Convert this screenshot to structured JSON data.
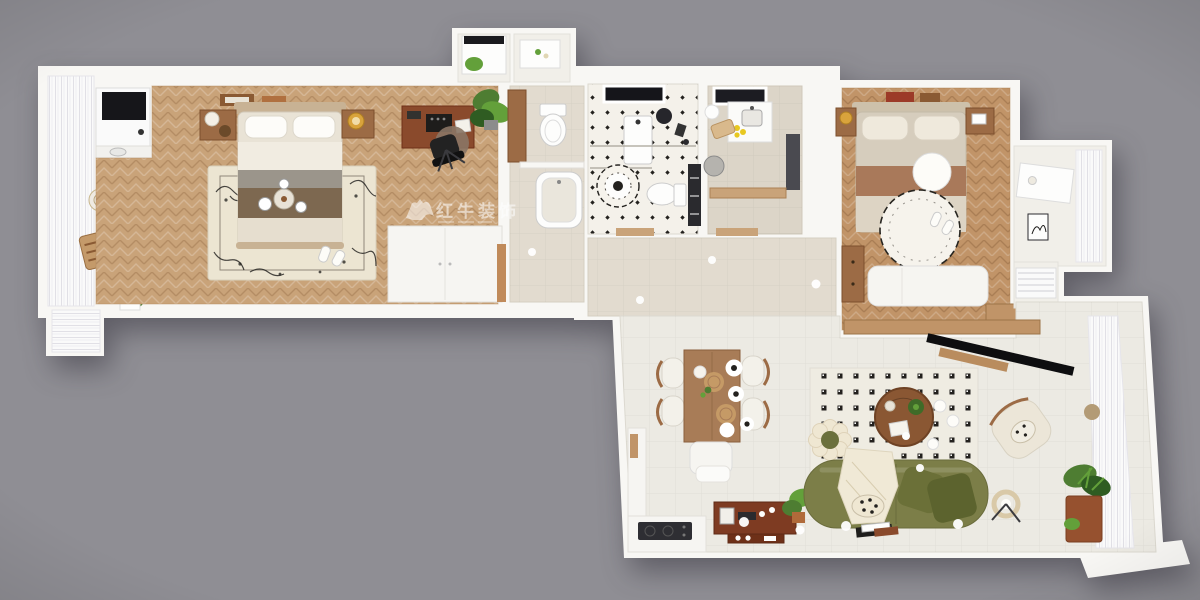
{
  "meta": {
    "title": "3D top-down apartment floor plan render",
    "width": 1200,
    "height": 600
  },
  "watermark": {
    "brand": "红牛装饰",
    "logo": "bull-logo-icon"
  },
  "palette": {
    "background": "#8f8e94",
    "wall": "#f8f7f4",
    "wood_floor_left": "#c9a379",
    "wood_floor_right": "#c19468",
    "tile_hall": "#e2dbcf",
    "tile_living": "#eceae3",
    "tile_bath": "#f4f1ea",
    "kitchen_floor": "#dcd5c8",
    "rug_cream": "#ece5d2",
    "rug_grid": "#efece2",
    "sofa_green": "#7c7e48",
    "pillow_olive_1": "#6b7038",
    "pillow_olive_2": "#5c632e",
    "throw_cream": "#f0e9d6",
    "table_wood": "#a87c57",
    "coffee_table_wood": "#8a5733",
    "console_wood": "#7e3b22",
    "desk_wood": "#8a4a2c",
    "bed_blanket_brown": "#7d6850",
    "bed_duvet": "#e9e3d6",
    "bed2_throw": "#a9795a",
    "plant_green": "#4e7d32",
    "lemon_yellow": "#e8c820",
    "accent_black": "#1e1d1b",
    "curtain_white": "#fafafa"
  },
  "scene": {
    "type": "apartment-floor-plan-3d",
    "rooms": [
      {
        "id": "balcony-left",
        "label": "left balcony",
        "items": [
          "curtains",
          "washing machine",
          "checkered mat",
          "glass side table",
          "lounge chair",
          "plants"
        ]
      },
      {
        "id": "master-bedroom",
        "label": "master bedroom",
        "items": [
          "double bed",
          "breakfast tray",
          "floral rug",
          "nightstands",
          "table lamps",
          "desk",
          "typewriter",
          "office chair",
          "round chair mat",
          "wardrobe",
          "potted plant",
          "slippers",
          "wall frames"
        ]
      },
      {
        "id": "entry",
        "label": "entry hall",
        "items": [
          "laundry room",
          "utility room",
          "tall cabinet",
          "toilet",
          "bathtub",
          "downlight"
        ]
      },
      {
        "id": "bathroom",
        "label": "bathroom",
        "items": [
          "skylight",
          "vanity",
          "shower fixture",
          "glass partition",
          "flower mat",
          "toilet",
          "storage rack",
          "door threshold"
        ]
      },
      {
        "id": "kitchen",
        "label": "kitchen",
        "items": [
          "window",
          "counter",
          "sink",
          "lemons",
          "cutting board",
          "tall fridge cabinet",
          "stool",
          "pendant lamp",
          "base cabinets"
        ]
      },
      {
        "id": "hallway",
        "label": "hallway",
        "items": [
          "downlights",
          "door thresholds"
        ]
      },
      {
        "id": "bedroom-2",
        "label": "second bedroom",
        "items": [
          "double bed",
          "round pouf",
          "striped round rug",
          "nightstands",
          "daybed",
          "dresser",
          "picture frames",
          "slippers",
          "wood cabinet"
        ]
      },
      {
        "id": "dressing-nook",
        "label": "dressing nook",
        "items": [
          "vanity desk",
          "curtains",
          "artwork",
          "hanging clothes"
        ]
      },
      {
        "id": "living-dining-room",
        "label": "living and dining room",
        "items": [
          "dining table",
          "dining chairs",
          "dining bench",
          "tableware",
          "placemats",
          "kitchen counter",
          "cooktop",
          "media console",
          "green sofa",
          "throw blanket",
          "leopard pillow",
          "olive pillows",
          "checker rug",
          "round coffee table",
          "flower pouf",
          "armchair",
          "ring floor lamp",
          "wall tv",
          "wood ledge",
          "magazines",
          "plants",
          "downlights"
        ]
      },
      {
        "id": "balcony-right",
        "label": "right balcony",
        "items": [
          "curtains",
          "potted plant",
          "wall light"
        ]
      }
    ]
  }
}
